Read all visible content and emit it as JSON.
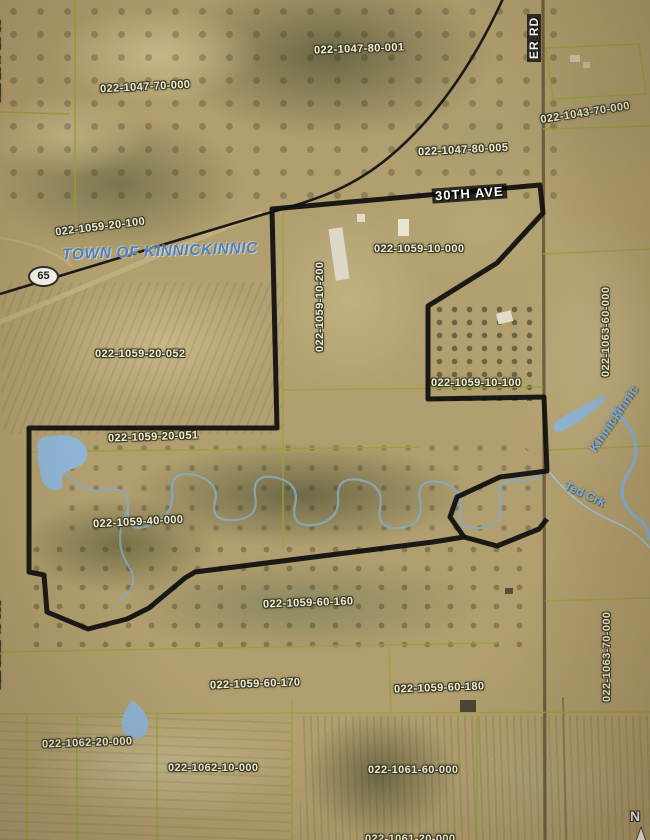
{
  "map": {
    "town": "TOWN OF KINNICKINNIC",
    "highway_shield": "65",
    "roads": {
      "thirtieth_ave": "30TH AVE",
      "north_south_road_partial": "ER RD"
    },
    "water": {
      "river": "Kinnickinnic",
      "creek": "Ted Crk"
    },
    "north_arrow": "N",
    "parcels": {
      "p_1047_70_000": "022-1047-70-000",
      "p_1047_80_001": "022-1047-80-001",
      "p_1047_80_005": "022-1047-80-005",
      "p_1043_70_000": "022-1043-70-000",
      "p_1047_20_partial": "022-1047-20-05",
      "p_1059_20_100": "022-1059-20-100",
      "p_1059_20_052": "022-1059-20-052",
      "p_1059_10_200": "022-1059-10-200",
      "p_1059_10_000": "022-1059-10-000",
      "p_1059_10_100": "022-1059-10-100",
      "p_1059_20_051": "022-1059-20-051",
      "p_1059_40_000": "022-1059-40-000",
      "p_1059_60_160": "022-1059-60-160",
      "p_1059_60_170": "022-1059-60-170",
      "p_1059_60_180": "022-1059-60-180",
      "p_1062_20_000": "022-1062-20-000",
      "p_1062_10_000": "022-1062-10-000",
      "p_1061_60_000": "022-1061-60-000",
      "p_1063_60_000": "022-1063-60-000",
      "p_1063_70_000": "022-1063-70-000",
      "p_1062_40_partial": "022-1062-40-000",
      "p_1061_bottom_partial": "022-1061-20-000"
    }
  }
}
